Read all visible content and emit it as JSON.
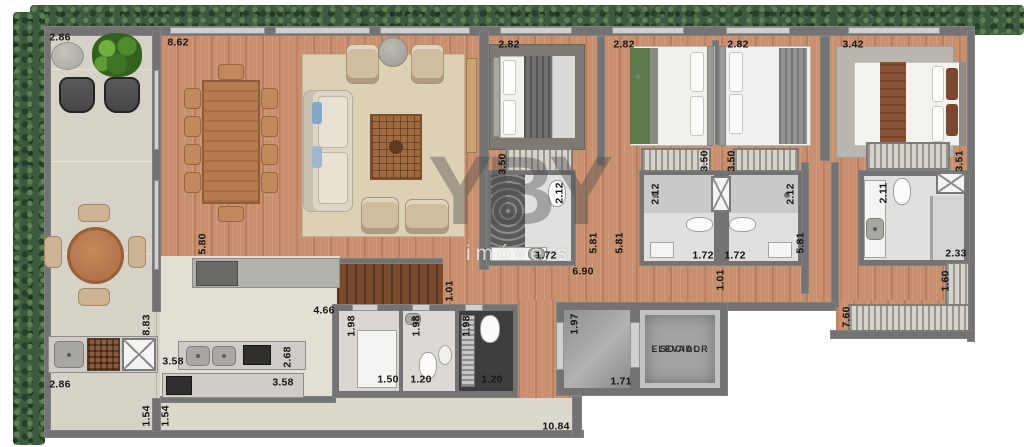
{
  "watermark": {
    "brand": "YBY",
    "subtitle": "imóveis"
  },
  "elevator": {
    "line1": "ELEVADOR",
    "line2": "SOCIAL"
  },
  "dimensions": {
    "balcony_width_top": "2.86",
    "living_width": "8.62",
    "bedroom1_width": "2.82",
    "bedroom2_width": "2.82",
    "bedroom3_width": "2.82",
    "master_width": "3.42",
    "bedroom1_depth": "3.50",
    "bedroom2_depth": "3.50",
    "bedroom3_depth": "3.50",
    "master_depth": "3.51",
    "bath1_depth": "2.12",
    "bath2_depth": "2.12",
    "bath3_depth": "2.12",
    "master_bath_depth": "2.11",
    "bath1_width": "1.72",
    "bath2_width": "1.72",
    "bath3_width": "1.72",
    "master_bath_width": "2.33",
    "hall_depth_a": "5.81",
    "hall_depth_b": "5.81",
    "hall_depth_c": "5.81",
    "living_depth": "5.80",
    "hall_length": "6.90",
    "pass_living": "1.01",
    "pass_hall": "1.01",
    "kitchen_width": "4.66",
    "balcony_depth": "8.83",
    "laundry_depth": "1.98",
    "wc_depth": "1.98",
    "service_bath_depth": "1.98",
    "laundry_width": "1.50",
    "wc_width": "1.20",
    "service_bath_width": "1.20",
    "hall_cell_depth": "1.97",
    "hall_cell_width": "1.71",
    "counter_width_a": "3.58",
    "counter_width_b": "3.58",
    "counter_depth": "2.68",
    "bbq_width": "2.86",
    "closet_depth": "1.60",
    "corridor_right_depth": "7.60",
    "service_pass_a": "1.54",
    "service_pass_b": "1.54",
    "service_corridor_length": "10.84"
  },
  "colors": {
    "wall": "#737373",
    "wood": "#c9906f",
    "wood-dark": "#7b4b2e",
    "balcony-floor": "#d7d2c8",
    "kitchen-floor": "#e4dfd4",
    "hedge": "#3b5a3e",
    "bath-floor": "#e0e0de",
    "counter": "#cfccc7",
    "living-rug": "#dcd0b5",
    "bedroom-rug": "#7d7a72",
    "master-rug": "#b9b6b0",
    "bed-green": "#5d7a4f",
    "bed-brown": "#8a5134",
    "furniture-wood": "#b57a50",
    "dark-fixture": "#2f2f2d",
    "label": "#151515"
  }
}
